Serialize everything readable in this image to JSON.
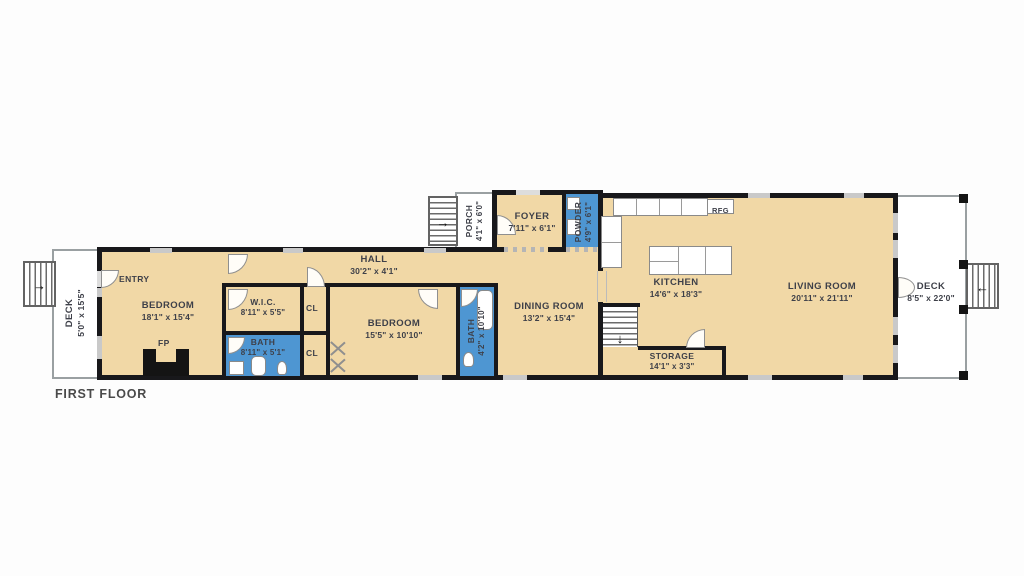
{
  "title": "FIRST FLOOR",
  "colors": {
    "room_fill": "#f1d8a6",
    "wet_room_fill": "#4e96d2",
    "wall": "#18181b",
    "window": "#c9c9c9",
    "deck_border": "#9aa0a2",
    "label_text": "#3e4049"
  },
  "icons": {
    "arrow_right": "→",
    "arrow_left": "←",
    "arrow_down": "↓"
  },
  "rooms": {
    "deck_left": {
      "name": "DECK",
      "dims": "5'0\" x 15'5\""
    },
    "entry": {
      "name": "ENTRY"
    },
    "bedroom1": {
      "name": "BEDROOM",
      "dims": "18'1\" x 15'4\""
    },
    "fireplace": {
      "name": "FP"
    },
    "hall": {
      "name": "HALL",
      "dims": "30'2\" x 4'1\""
    },
    "wic": {
      "name": "W.I.C.",
      "dims": "8'11\" x 5'5\""
    },
    "bath1": {
      "name": "BATH",
      "dims": "8'11\" x 5'1\""
    },
    "cl1": {
      "name": "CL"
    },
    "cl2": {
      "name": "CL"
    },
    "bedroom2": {
      "name": "BEDROOM",
      "dims": "15'5\" x 10'10\""
    },
    "bath2": {
      "name": "BATH",
      "dims": "4'2\" x 10'10\""
    },
    "porch": {
      "name": "PORCH",
      "dims": "4'1\" x 6'0\""
    },
    "foyer": {
      "name": "FOYER",
      "dims": "7'11\" x 6'1\""
    },
    "powder": {
      "name": "POWDER",
      "dims": "4'9\" x 6'1\""
    },
    "dining": {
      "name": "DINING ROOM",
      "dims": "13'2\" x 15'4\""
    },
    "kitchen": {
      "name": "KITCHEN",
      "dims": "14'6\" x 18'3\""
    },
    "rfg": {
      "name": "RFG"
    },
    "storage": {
      "name": "STORAGE",
      "dims": "14'1\" x 3'3\""
    },
    "living": {
      "name": "LIVING ROOM",
      "dims": "20'11\" x 21'11\""
    },
    "deck_right": {
      "name": "DECK",
      "dims": "8'5\" x 22'0\""
    }
  }
}
